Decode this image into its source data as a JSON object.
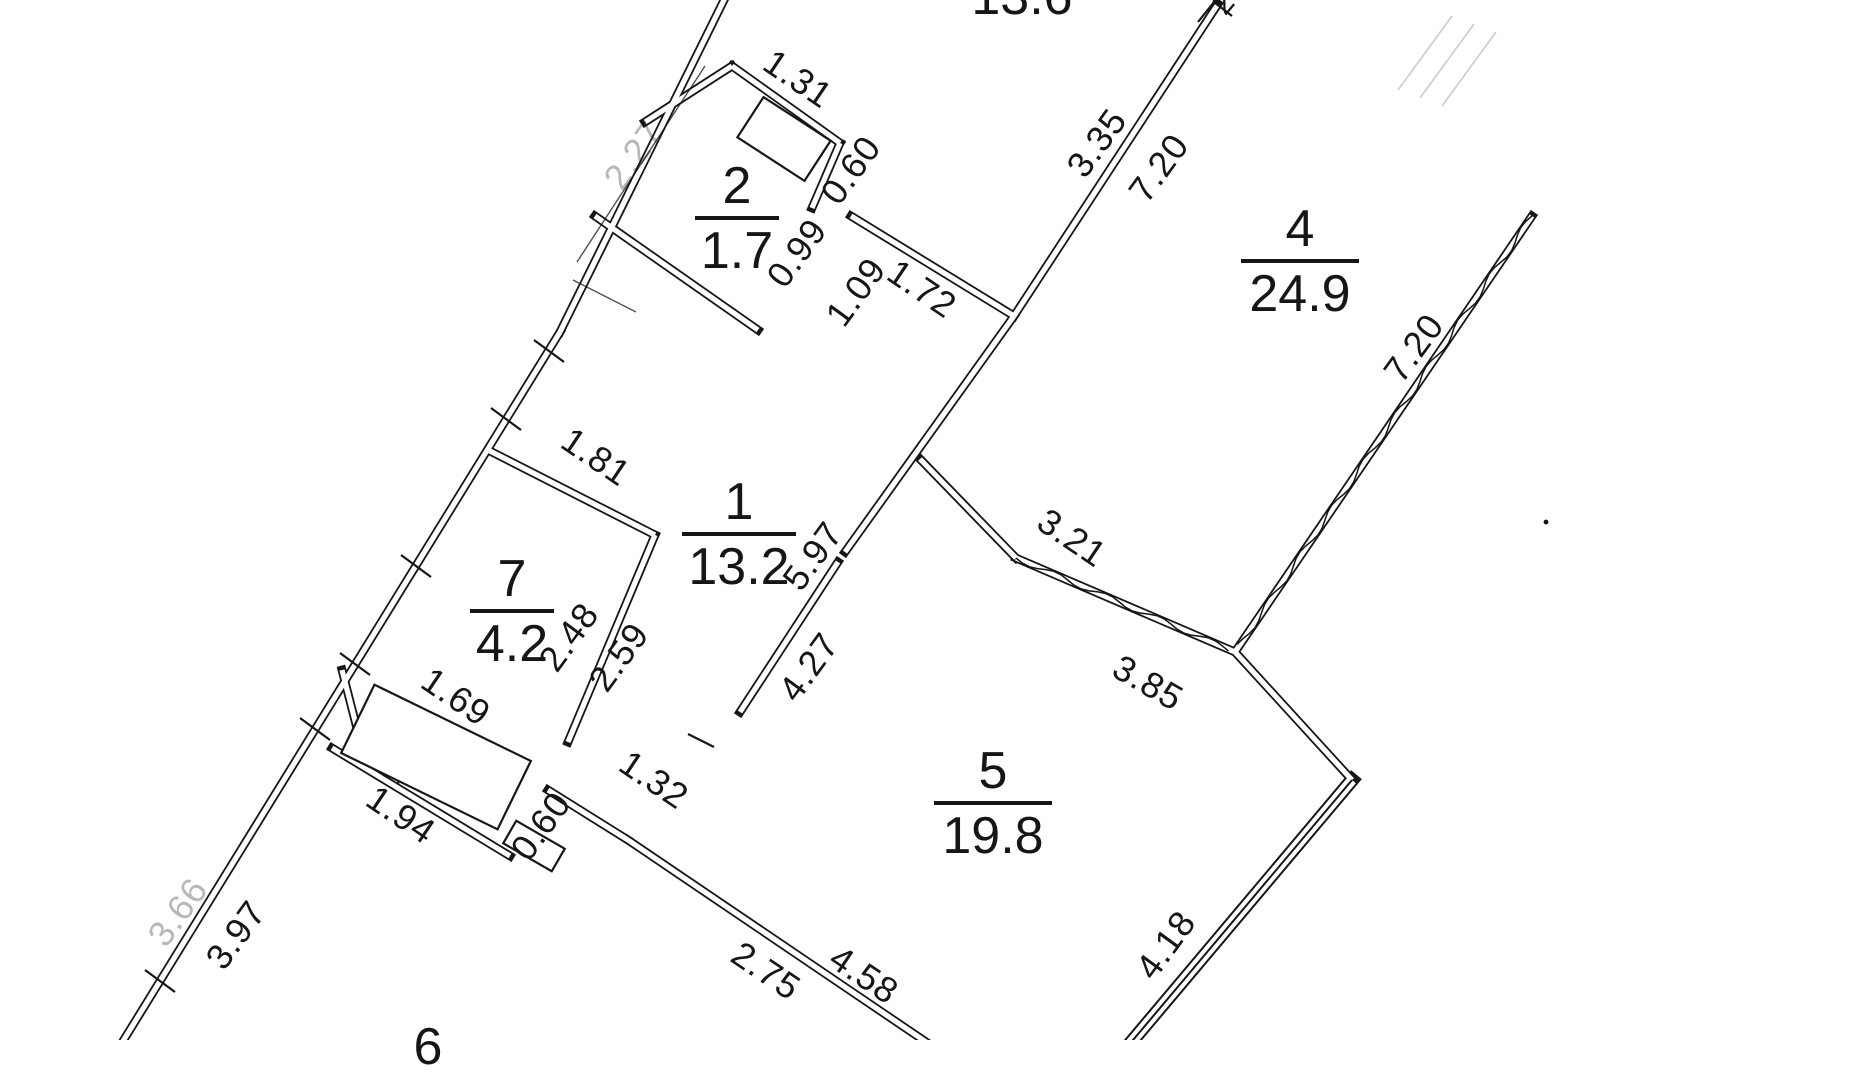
{
  "title": "apartment-floor-plan-scan",
  "colors": {
    "ink": "#161616",
    "faint_ink": "#8f8f8f",
    "background": "#ffffff"
  },
  "canvas": {
    "width": 1850,
    "height": 1040
  },
  "plan": {
    "rooms": [
      {
        "number": "",
        "area": "13.6",
        "cx": 1022,
        "top": -30,
        "rule": 0
      },
      {
        "number": "2",
        "area": "1.7",
        "cx": 737,
        "top": 159,
        "rule": 84
      },
      {
        "number": "4",
        "area": "24.9",
        "cx": 1300,
        "top": 202,
        "rule": 118
      },
      {
        "number": "1",
        "area": "13.2",
        "cx": 739,
        "top": 475,
        "rule": 114
      },
      {
        "number": "7",
        "area": "4.2",
        "cx": 512,
        "top": 552,
        "rule": 84
      },
      {
        "number": "5",
        "area": "19.8",
        "cx": 993,
        "top": 744,
        "rule": 118
      },
      {
        "number": "6",
        "area": "",
        "cx": 428,
        "top": 1020,
        "rule": 0
      }
    ],
    "dimensions": [
      {
        "t": "1.31",
        "x": 798,
        "y": 79,
        "r": 34
      },
      {
        "t": "0.60",
        "x": 851,
        "y": 170,
        "r": -54
      },
      {
        "t": "0.99",
        "x": 797,
        "y": 253,
        "r": -54
      },
      {
        "t": "1.09",
        "x": 856,
        "y": 292,
        "r": -54
      },
      {
        "t": "1.72",
        "x": 922,
        "y": 289,
        "r": 34
      },
      {
        "t": "3.35",
        "x": 1097,
        "y": 143,
        "r": -54
      },
      {
        "t": "7.20",
        "x": 1159,
        "y": 168,
        "r": -54
      },
      {
        "t": "7.20",
        "x": 1414,
        "y": 348,
        "r": -54
      },
      {
        "t": "1.81",
        "x": 596,
        "y": 457,
        "r": 34
      },
      {
        "t": "5.97",
        "x": 813,
        "y": 556,
        "r": -54
      },
      {
        "t": "2.48",
        "x": 569,
        "y": 637,
        "r": -54
      },
      {
        "t": "2.59",
        "x": 619,
        "y": 657,
        "r": -54
      },
      {
        "t": "4.27",
        "x": 809,
        "y": 667,
        "r": -54
      },
      {
        "t": "3.21",
        "x": 1072,
        "y": 538,
        "r": 34
      },
      {
        "t": "3.85",
        "x": 1148,
        "y": 683,
        "r": 30
      },
      {
        "t": "1.69",
        "x": 456,
        "y": 697,
        "r": 34
      },
      {
        "t": "1.94",
        "x": 401,
        "y": 815,
        "r": 34
      },
      {
        "t": "0.60",
        "x": 541,
        "y": 826,
        "r": -54
      },
      {
        "t": "1.32",
        "x": 654,
        "y": 780,
        "r": 34
      },
      {
        "t": "2.75",
        "x": 766,
        "y": 971,
        "r": 34
      },
      {
        "t": "4.58",
        "x": 864,
        "y": 975,
        "r": 34
      },
      {
        "t": "4.18",
        "x": 1166,
        "y": 945,
        "r": -54
      },
      {
        "t": "3.97",
        "x": 236,
        "y": 935,
        "r": -54
      },
      {
        "t": "3.66",
        "x": 178,
        "y": 912,
        "r": -54,
        "o": 0.3
      },
      {
        "t": "2.27",
        "x": 634,
        "y": 155,
        "r": -54,
        "o": 0.3
      },
      {
        "t": "2",
        "x": 1224,
        "y": 4,
        "r": -50,
        "s": 30
      }
    ],
    "walls": [
      [
        "f",
        1398,
        90,
        1452,
        16
      ],
      [
        "f",
        1420,
        98,
        1474,
        24
      ],
      [
        "f",
        1442,
        106,
        1496,
        32
      ],
      [
        "d",
        727,
        -6,
        560,
        332
      ],
      [
        "d",
        560,
        332,
        120,
        1046
      ],
      [
        "d",
        645,
        122,
        732,
        66
      ],
      [
        "d",
        732,
        66,
        840,
        143
      ],
      [
        "d",
        840,
        143,
        812,
        208
      ],
      [
        "d",
        595,
        216,
        758,
        330
      ],
      [
        "d",
        851,
        216,
        1014,
        316
      ],
      [
        "d",
        1014,
        316,
        1218,
        4
      ],
      [
        "w",
        1532,
        216,
        1235,
        652
      ],
      [
        "w",
        1016,
        558,
        1235,
        652
      ],
      [
        "d",
        920,
        459,
        1016,
        558
      ],
      [
        "d",
        1014,
        316,
        845,
        552
      ],
      [
        "d",
        838,
        562,
        740,
        712
      ],
      [
        "d",
        488,
        450,
        655,
        535
      ],
      [
        "d",
        655,
        535,
        568,
        742
      ],
      [
        "d",
        342,
        670,
        362,
        748
      ],
      [
        "d",
        332,
        748,
        510,
        856
      ],
      [
        "d",
        548,
        790,
        628,
        840
      ],
      [
        "d",
        628,
        840,
        932,
        1046
      ],
      [
        "d",
        1235,
        652,
        1352,
        780
      ],
      [
        "3",
        1352,
        780,
        1128,
        1046
      ],
      [
        "s",
        534,
        340,
        564,
        362
      ],
      [
        "s",
        491,
        408,
        521,
        430
      ],
      [
        "s",
        401,
        555,
        431,
        577
      ],
      [
        "s",
        340,
        653,
        370,
        675
      ],
      [
        "s",
        300,
        718,
        330,
        740
      ],
      [
        "s",
        145,
        970,
        175,
        992
      ],
      [
        "s",
        1198,
        22,
        1214,
        2
      ],
      [
        "s",
        1214,
        2,
        1232,
        16
      ],
      [
        "s",
        688,
        734,
        714,
        747
      ],
      [
        "s",
        412,
        706,
        398,
        784
      ],
      [
        "n",
        705,
        66,
        577,
        262
      ],
      [
        "n",
        573,
        280,
        636,
        312
      ]
    ],
    "rects": [
      {
        "cx": 436,
        "cy": 757,
        "w": 174,
        "h": 76,
        "rot": 26
      },
      {
        "cx": 784,
        "cy": 139,
        "w": 80,
        "h": 48,
        "rot": 33
      },
      {
        "cx": 534,
        "cy": 846,
        "w": 56,
        "h": 26,
        "rot": 30
      }
    ],
    "dots": [
      [
        1546,
        522
      ]
    ]
  }
}
